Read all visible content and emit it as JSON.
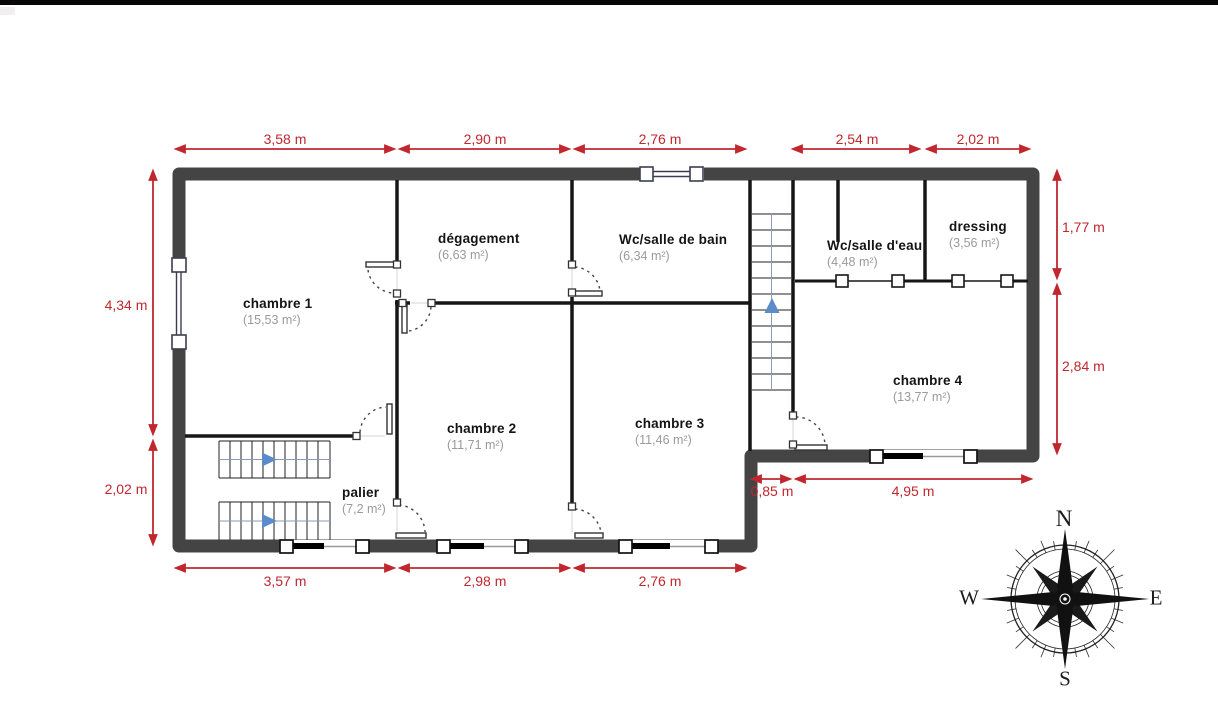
{
  "plan": {
    "rooms": [
      {
        "name": "chambre 1",
        "area": "(15,53 m²)"
      },
      {
        "name": "dégagement",
        "area": "(6,63 m²)"
      },
      {
        "name": "Wc/salle de bain",
        "area": "(6,34 m²)"
      },
      {
        "name": "Wc/salle d'eau",
        "area": "(4,48 m²)"
      },
      {
        "name": "dressing",
        "area": "(3,56 m²)"
      },
      {
        "name": "chambre 2",
        "area": "(11,71 m²)"
      },
      {
        "name": "chambre 3",
        "area": "(11,46 m²)"
      },
      {
        "name": "chambre 4",
        "area": "(13,77 m²)"
      },
      {
        "name": "palier",
        "area": "(7,2 m²)"
      }
    ],
    "dimensions": {
      "top": [
        "3,58 m",
        "2,90 m",
        "2,76 m",
        "2,54 m",
        "2,02 m"
      ],
      "bottom": [
        "3,57 m",
        "2,98 m",
        "2,76 m"
      ],
      "left": [
        "4,34 m",
        "2,02 m"
      ],
      "right": [
        "1,77 m",
        "2,84 m"
      ],
      "step": "0,85 m",
      "bottom_right": "4,95 m"
    },
    "compass": {
      "north": "N",
      "east": "E",
      "south": "S",
      "west": "W"
    },
    "colors": {
      "dimension_red": "#c0272f",
      "wall_dark": "#444444",
      "interior_wall": "#161616",
      "stair_arrow_blue": "#5b8bc9"
    }
  }
}
